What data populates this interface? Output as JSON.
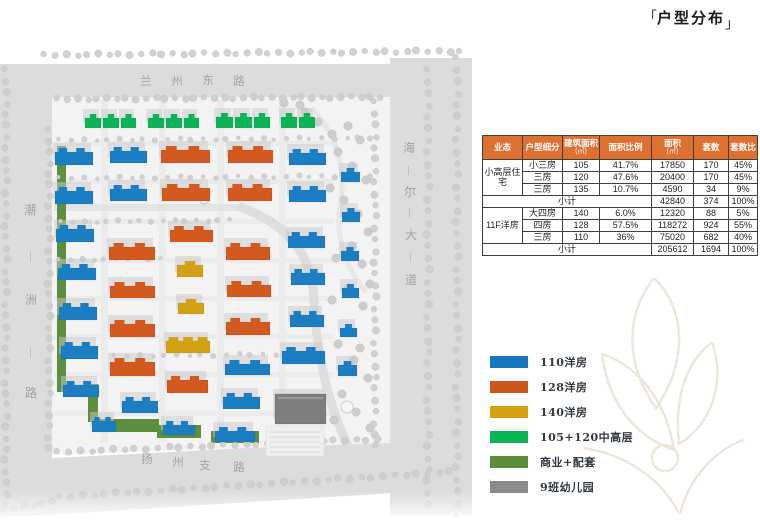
{
  "title": {
    "open": "「",
    "text": "户型分布",
    "close": "」"
  },
  "table": {
    "subtotal_label": "小计",
    "headers": [
      {
        "t": "业态"
      },
      {
        "t": "户型细分"
      },
      {
        "t": "建筑面积",
        "s": "(㎡)"
      },
      {
        "t": "面积比例"
      },
      {
        "t": "面积",
        "s": "(㎡)"
      },
      {
        "t": "套数"
      },
      {
        "t": "套数比"
      }
    ],
    "groups": [
      {
        "name": "小高层住宅",
        "rows": [
          [
            "小三房",
            "105",
            "41.7%",
            "17850",
            "170",
            "45%"
          ],
          [
            "三房",
            "120",
            "47.6%",
            "20400",
            "170",
            "45%"
          ],
          [
            "三房",
            "135",
            "10.7%",
            "4590",
            "34",
            "9%"
          ]
        ],
        "subtotal": [
          "42840",
          "374",
          "100%"
        ]
      },
      {
        "name": "11F洋房",
        "rows": [
          [
            "大四房",
            "140",
            "6.0%",
            "12320",
            "88",
            "5%"
          ],
          [
            "四房",
            "128",
            "57.5%",
            "118272",
            "924",
            "55%"
          ],
          [
            "三房",
            "110",
            "36%",
            "75020",
            "682",
            "40%"
          ]
        ],
        "subtotal": [
          "205612",
          "1694",
          "100%"
        ]
      }
    ]
  },
  "legend": {
    "items": [
      {
        "color": "#1577BE",
        "label": "110洋房"
      },
      {
        "color": "#CC5619",
        "label": "128洋房"
      },
      {
        "color": "#D2A112",
        "label": "140洋房"
      },
      {
        "color": "#0CB457",
        "label": "105+120中高层"
      },
      {
        "color": "#5C8D3D",
        "label": "商业+配套"
      },
      {
        "color": "#8B8B8B",
        "label": "9班幼儿园"
      }
    ]
  },
  "map": {
    "road_labels": {
      "top": "兰州东路",
      "left": "潮洲路",
      "right": "海尔大道",
      "bottom": "扬州支路"
    },
    "palette": {
      "b": "#1B7EC3",
      "o": "#D3591E",
      "y": "#D2A214",
      "g": "#0FB357",
      "v": "#5C8F3E",
      "k": "#7E7E7E",
      "road": "#DCDCDC",
      "site": "#F3F3F3",
      "tree": "#CDCDCD",
      "label": "#9EA3A8"
    },
    "buildings": [
      [
        85,
        114,
        16,
        14,
        "g",
        1
      ],
      [
        103,
        114,
        16,
        14,
        "g",
        1
      ],
      [
        121,
        114,
        15,
        14,
        "g",
        1
      ],
      [
        148,
        114,
        16,
        14,
        "g",
        1
      ],
      [
        166,
        114,
        16,
        14,
        "g",
        1
      ],
      [
        184,
        114,
        15,
        14,
        "g",
        1
      ],
      [
        216,
        113,
        17,
        15,
        "g",
        1
      ],
      [
        235,
        113,
        17,
        15,
        "g",
        1
      ],
      [
        254,
        113,
        16,
        15,
        "g",
        1
      ],
      [
        281,
        113,
        16,
        15,
        "g",
        1
      ],
      [
        299,
        113,
        16,
        15,
        "g",
        1
      ],
      [
        55,
        148,
        38,
        17,
        "b",
        2
      ],
      [
        55,
        187,
        38,
        17,
        "b",
        2
      ],
      [
        56,
        225,
        38,
        17,
        "b",
        2
      ],
      [
        58,
        264,
        38,
        16,
        "b",
        2
      ],
      [
        59,
        303,
        38,
        17,
        "b",
        2
      ],
      [
        61,
        342,
        37,
        17,
        "b",
        2
      ],
      [
        63,
        381,
        36,
        16,
        "b",
        2
      ],
      [
        110,
        147,
        37,
        16,
        "b",
        2
      ],
      [
        110,
        185,
        37,
        16,
        "b",
        2
      ],
      [
        109,
        243,
        46,
        17,
        "o",
        2
      ],
      [
        110,
        282,
        45,
        16,
        "o",
        2
      ],
      [
        110,
        320,
        45,
        17,
        "o",
        2
      ],
      [
        110,
        358,
        45,
        18,
        "o",
        2
      ],
      [
        122,
        397,
        36,
        16,
        "b",
        2
      ],
      [
        161,
        146,
        49,
        17,
        "o",
        2
      ],
      [
        162,
        184,
        48,
        17,
        "o",
        2
      ],
      [
        170,
        226,
        43,
        16,
        "o",
        2
      ],
      [
        177,
        261,
        26,
        16,
        "y",
        1
      ],
      [
        178,
        299,
        26,
        15,
        "y",
        1
      ],
      [
        166,
        337,
        44,
        16,
        "y",
        3
      ],
      [
        167,
        376,
        41,
        17,
        "o",
        2
      ],
      [
        228,
        146,
        45,
        17,
        "o",
        2
      ],
      [
        228,
        184,
        44,
        17,
        "o",
        2
      ],
      [
        226,
        243,
        44,
        17,
        "o",
        2
      ],
      [
        227,
        281,
        44,
        16,
        "o",
        2
      ],
      [
        226,
        318,
        44,
        17,
        "o",
        2
      ],
      [
        225,
        360,
        45,
        15,
        "b",
        2
      ],
      [
        223,
        393,
        37,
        16,
        "b",
        2
      ],
      [
        289,
        149,
        37,
        16,
        "b",
        2
      ],
      [
        289,
        186,
        37,
        16,
        "b",
        2
      ],
      [
        288,
        232,
        37,
        16,
        "b",
        2
      ],
      [
        291,
        269,
        34,
        16,
        "b",
        2
      ],
      [
        290,
        311,
        34,
        16,
        "b",
        2
      ],
      [
        282,
        347,
        43,
        17,
        "b",
        2
      ],
      [
        341,
        168,
        19,
        14,
        "b",
        1
      ],
      [
        342,
        208,
        18,
        14,
        "b",
        1
      ],
      [
        341,
        247,
        18,
        14,
        "b",
        1
      ],
      [
        342,
        284,
        17,
        14,
        "b",
        1
      ],
      [
        340,
        324,
        17,
        13,
        "b",
        1
      ],
      [
        338,
        361,
        19,
        15,
        "b",
        1
      ],
      [
        92,
        417,
        24,
        15,
        "b",
        2
      ],
      [
        163,
        421,
        32,
        14,
        "b",
        2
      ],
      [
        215,
        427,
        40,
        15,
        "b",
        2
      ],
      [
        275,
        394,
        51,
        30,
        "k",
        0
      ]
    ],
    "strips": [
      [
        57,
        146,
        9,
        246
      ],
      [
        88,
        384,
        10,
        38
      ],
      [
        95,
        419,
        64,
        13
      ],
      [
        157,
        425,
        44,
        13
      ],
      [
        211,
        431,
        48,
        12
      ]
    ],
    "tree_rows": [
      [
        45,
        55,
        460,
        51,
        40,
        3
      ],
      [
        58,
        99,
        380,
        97,
        34,
        3
      ],
      [
        6,
        70,
        6,
        505,
        40,
        3
      ],
      [
        49,
        130,
        49,
        448,
        30,
        3
      ],
      [
        375,
        102,
        375,
        446,
        31,
        3
      ],
      [
        428,
        70,
        428,
        505,
        38,
        3
      ],
      [
        457,
        58,
        457,
        515,
        40,
        3
      ],
      [
        58,
        452,
        378,
        439,
        30,
        3
      ],
      [
        60,
        497,
        450,
        472,
        36,
        3
      ],
      [
        5,
        510,
        52,
        502,
        6,
        3
      ],
      [
        60,
        140,
        370,
        138,
        27,
        2
      ],
      [
        60,
        178,
        370,
        176,
        27,
        2
      ],
      [
        62,
        222,
        230,
        220,
        16,
        2
      ],
      [
        60,
        260,
        160,
        258,
        10,
        2
      ],
      [
        115,
        356,
        300,
        354,
        16,
        2
      ]
    ],
    "park_trees": [
      [
        305,
        112
      ],
      [
        318,
        122
      ],
      [
        332,
        134
      ],
      [
        348,
        126
      ],
      [
        360,
        140
      ],
      [
        338,
        152
      ],
      [
        352,
        166
      ],
      [
        366,
        180
      ],
      [
        330,
        188
      ],
      [
        344,
        200
      ],
      [
        358,
        214
      ],
      [
        368,
        232
      ],
      [
        352,
        246
      ],
      [
        336,
        258
      ],
      [
        362,
        264
      ],
      [
        370,
        284
      ],
      [
        348,
        288
      ],
      [
        332,
        300
      ],
      [
        300,
        105
      ],
      [
        284,
        103
      ],
      [
        363,
        306
      ],
      [
        338,
        344
      ],
      [
        354,
        360
      ],
      [
        368,
        378
      ],
      [
        342,
        394
      ],
      [
        356,
        412
      ],
      [
        370,
        428
      ],
      [
        334,
        420
      ],
      [
        360,
        348
      ]
    ]
  }
}
